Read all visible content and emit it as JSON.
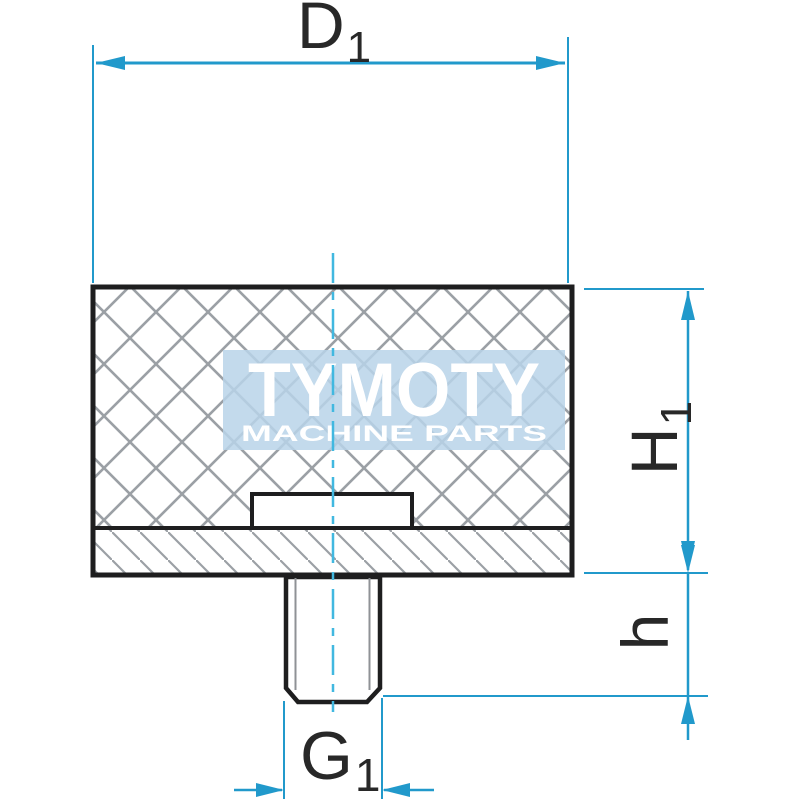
{
  "drawing": {
    "dimension_labels": {
      "diameter": {
        "base": "D",
        "sub": "1"
      },
      "body_height": {
        "base": "H",
        "sub": "1"
      },
      "stud_height": {
        "base": "h"
      },
      "thread": {
        "base": "G",
        "sub": "1"
      }
    },
    "watermark": {
      "brand": "TYMOTY",
      "tagline": "MACHINE PARTS"
    },
    "colors": {
      "dimension_blue": "#2199cb",
      "centerline_cyan": "#41b8e0",
      "outline_black": "#1e1e1f",
      "hatch_gray": "#9ba0a5",
      "watermark_bg": "#b8d3e9",
      "watermark_text": "#ffffff",
      "label_black": "#282828"
    }
  }
}
